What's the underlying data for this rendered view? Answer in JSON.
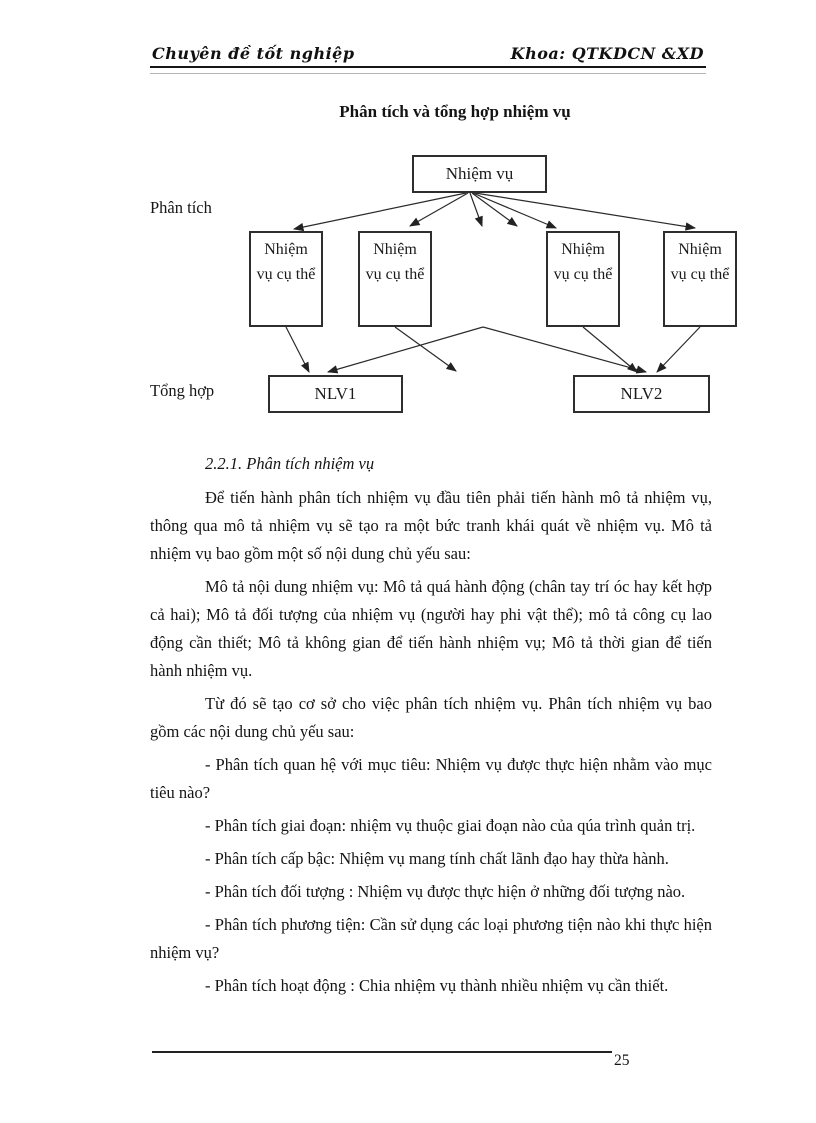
{
  "header": {
    "left": "Chuyên đề tốt nghiệp",
    "right": "Khoa: QTKDCN &XD"
  },
  "figure": {
    "title": "Phân tích và tổng hợp nhiệm vụ",
    "phase_labels": {
      "analysis": "Phân tích",
      "synthesis": "Tổng hợp"
    },
    "root_box": "Nhiệm vụ",
    "sub_boxes": [
      "Nhiệm vụ cụ thể",
      "Nhiệm vụ cụ thể",
      "Nhiệm vụ cụ thể",
      "Nhiệm vụ cụ thể"
    ],
    "result_boxes": [
      "NLV1",
      "NLV2"
    ]
  },
  "section": {
    "heading": "2.2.1. Phân tích nhiệm vụ",
    "paragraphs": [
      "Để tiến hành phân tích nhiệm vụ đầu tiên phải tiến hành mô tả nhiệm vụ, thông qua mô tả nhiệm vụ sẽ tạo ra một bức tranh khái quát về nhiệm vụ. Mô tả nhiệm vụ bao gồm một số nội dung chủ yếu sau:",
      "Mô tả nội dung nhiệm vụ: Mô tả quá hành động (chân tay trí óc hay kết hợp cả hai); Mô tả đối tượng của nhiệm vụ (người hay phi vật thể); mô tả công cụ lao động cần thiết; Mô tả không gian để tiến hành nhiệm vụ; Mô tả thời gian để tiến hành nhiệm vụ.",
      "Từ đó sẽ tạo cơ sở cho việc phân  tích nhiệm vụ. Phân tích nhiệm vụ bao gồm các nội dung chủ yếu sau:",
      "- Phân tích quan hệ với mục tiêu: Nhiệm vụ được thực hiện nhằm vào mục tiêu nào?",
      "- Phân tích giai đoạn: nhiệm vụ thuộc giai đoạn nào của qúa trình quản trị.",
      "- Phân tích cấp bậc: Nhiệm vụ mang tính chất lãnh đạo hay thừa hành.",
      "- Phân tích đối tượng : Nhiệm vụ được thực hiện ở những đối tượng nào.",
      "- Phân tích phương tiện: Cần sử dụng các loại phương tiện nào khi thực hiện nhiệm vụ?",
      "- Phân tích hoạt động : Chia nhiệm vụ thành nhiều nhiệm vụ cần thiết."
    ]
  },
  "footer": {
    "page_number": "25"
  }
}
